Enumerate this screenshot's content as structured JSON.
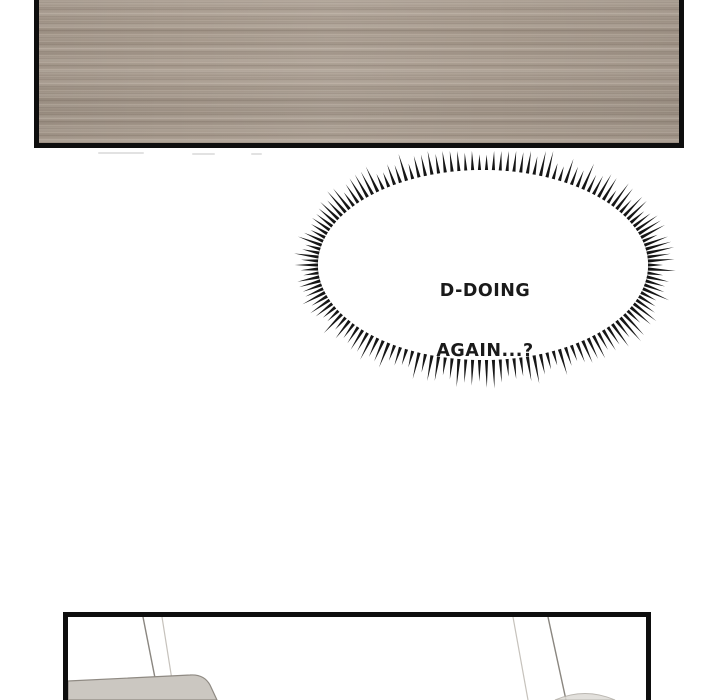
{
  "page": {
    "kind": "webtoon comic page",
    "background_color": "#ffffff",
    "ink_color": "#0e0e0e"
  },
  "panels": {
    "top": {
      "description": "close-up of a brown wood surface",
      "wood_base_color": "#a89b8e",
      "wood_light_streak": "#b9ac9e",
      "wood_dark_streak": "#93867a"
    },
    "bottom": {
      "description": "room interior: thin chair legs and a light-gray sofa arm",
      "object_fill": "#cbc7c1",
      "object_line": "#8f8a83",
      "leg_line_dark": "#8a8680",
      "leg_line_light": "#c6c2bc",
      "stool_fill": "#dedbd6",
      "stool_line": "#b0aca5"
    }
  },
  "speech_bubble": {
    "style": "spiky shout burst ellipse",
    "line1": "D-DOING",
    "line2": "AGAIN...?",
    "text_color": "#1a1a1a",
    "fill_color": "#ffffff",
    "spike_color": "#161616"
  }
}
